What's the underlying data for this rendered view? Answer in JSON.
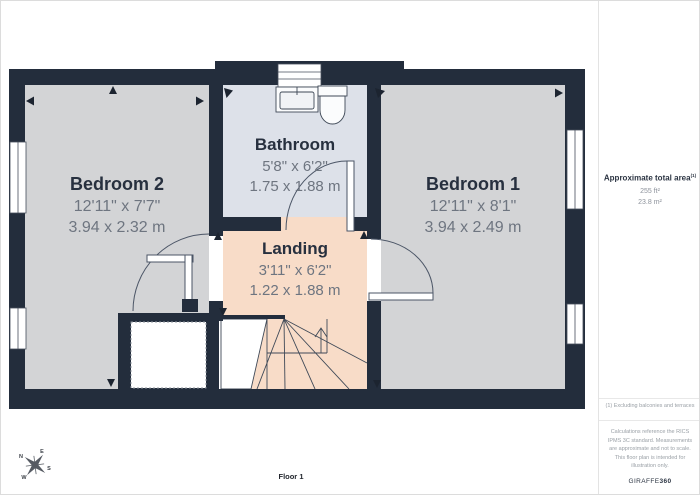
{
  "plan": {
    "floor_label": "Floor 1",
    "rooms": [
      {
        "name": "Bedroom 2",
        "imperial": "12'11\" x 7'7\"",
        "metric": "3.94 x 2.32 m"
      },
      {
        "name": "Bathroom",
        "imperial": "5'8\" x 6'2\"",
        "metric": "1.75 x 1.88 m"
      },
      {
        "name": "Landing",
        "imperial": "3'11\" x 6'2\"",
        "metric": "1.22 x 1.88 m"
      },
      {
        "name": "Bedroom 1",
        "imperial": "12'11\" x 8'1\"",
        "metric": "3.94 x 2.49 m"
      }
    ],
    "compass": {
      "n": "N",
      "e": "E",
      "s": "S",
      "w": "W"
    }
  },
  "sidebar": {
    "area_title": "Approximate total area",
    "area_superscript": "(1)",
    "area_imperial": "255 ft²",
    "area_metric": "23.8 m²",
    "footnote": "(1) Excluding balconies and terraces",
    "disclaimer": "Calculations reference the RICS IPMS 3C standard. Measurements are approximate and not to scale. This floor plan is intended for illustration only.",
    "brand_name": "GIRAFFE",
    "brand_suffix": "360"
  },
  "colors": {
    "wall": "#232d3c",
    "bedroom_floor": "#d3d4d6",
    "bathroom_floor": "#dde1e9",
    "landing_floor": "#f8dcc8",
    "heading_text": "#27303f",
    "dimension_text": "#6e7580",
    "line": "#3f4957"
  }
}
